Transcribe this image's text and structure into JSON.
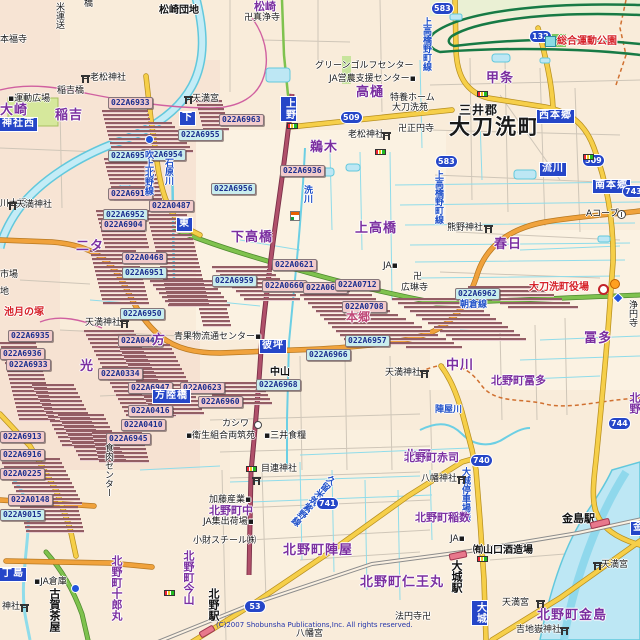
{
  "map": {
    "attribution": "(C)2007 Shobunsha Publications,Inc. All rights reserved.",
    "colors": {
      "background": "#F9ECDA",
      "water_fill": "#BDE7F4",
      "water_line": "#62C8DC",
      "road_yellow": "#F6CF49",
      "road_orange": "#F0A23C",
      "road_green": "#7FC24E",
      "road_red": "#B0506A",
      "expressway_green": "#177A45",
      "boundary_magenta": "#D060A0",
      "boundary_dashed": "#D07030",
      "label_purple": "#7B2FA0",
      "label_red": "#D6232A",
      "blue_box": "#2546C8",
      "code_pink": "#F2CBCB",
      "code_cyan": "#C9EDED",
      "stripe_dark": "#935D64",
      "railway_gray": "#8C8C8C",
      "station_pink": "#E8788C"
    },
    "shields": [
      {
        "n": "583",
        "x": 432,
        "y": 3
      },
      {
        "n": "132",
        "x": 530,
        "y": 31
      },
      {
        "n": "509",
        "x": 341,
        "y": 112
      },
      {
        "n": "583",
        "x": 436,
        "y": 156
      },
      {
        "n": "509",
        "x": 583,
        "y": 155
      },
      {
        "n": "743",
        "x": 623,
        "y": 186
      },
      {
        "n": "744",
        "x": 609,
        "y": 418
      },
      {
        "n": "740",
        "x": 471,
        "y": 455
      },
      {
        "n": "741",
        "x": 317,
        "y": 498
      },
      {
        "n": "53",
        "x": 245,
        "y": 601
      }
    ],
    "blue_boxes": [
      {
        "t": "上野",
        "x": 281,
        "y": 97,
        "v": true
      },
      {
        "t": "下",
        "x": 180,
        "y": 112,
        "v": false
      },
      {
        "t": "神社西",
        "x": 0,
        "y": 118,
        "v": false
      },
      {
        "t": "東",
        "x": 177,
        "y": 218,
        "v": false
      },
      {
        "t": "西本郷",
        "x": 537,
        "y": 110,
        "v": false
      },
      {
        "t": "流川",
        "x": 540,
        "y": 163,
        "v": false
      },
      {
        "t": "南本郷",
        "x": 593,
        "y": 180,
        "v": false
      },
      {
        "t": "彼坪",
        "x": 260,
        "y": 340,
        "v": false
      },
      {
        "t": "方陸橋",
        "x": 153,
        "y": 390,
        "v": false
      },
      {
        "t": "丁島",
        "x": 0,
        "y": 568,
        "v": false
      },
      {
        "t": "大城",
        "x": 472,
        "y": 601,
        "v": true
      },
      {
        "t": "金",
        "x": 631,
        "y": 522,
        "v": false
      }
    ],
    "labels": [
      {
        "t": "米運送",
        "x": 54,
        "y": 2,
        "c": "c-poi",
        "v": true
      },
      {
        "t": "松崎団地",
        "x": 159,
        "y": 6,
        "c": "c-poib"
      },
      {
        "t": "橋",
        "x": 84,
        "y": 0,
        "c": "c-poi"
      },
      {
        "t": "本福寺",
        "x": 0,
        "y": 36,
        "c": "c-poi"
      },
      {
        "t": "卍真浄寺",
        "x": 244,
        "y": 14,
        "c": "c-poi"
      },
      {
        "t": "松崎",
        "x": 254,
        "y": 1,
        "c": "c-loc2"
      },
      {
        "t": "老松神社",
        "x": 90,
        "y": 74,
        "c": "c-poi"
      },
      {
        "t": "稲吉橋",
        "x": 57,
        "y": 87,
        "c": "c-poi"
      },
      {
        "t": "▪運動広場",
        "x": 8,
        "y": 95,
        "c": "c-poi"
      },
      {
        "t": "稲吉",
        "x": 55,
        "y": 109,
        "c": "c-loc"
      },
      {
        "t": "大崎",
        "x": 0,
        "y": 104,
        "c": "c-loc"
      },
      {
        "t": "天満宮",
        "x": 192,
        "y": 95,
        "c": "c-poi"
      },
      {
        "t": "グリーンゴルフセンター",
        "x": 315,
        "y": 62,
        "c": "c-poi"
      },
      {
        "t": "JA営農支援センター▪",
        "x": 329,
        "y": 75,
        "c": "c-poi"
      },
      {
        "t": "高樋",
        "x": 356,
        "y": 86,
        "c": "c-loc"
      },
      {
        "t": "特養ホーム",
        "x": 390,
        "y": 94,
        "c": "c-poi"
      },
      {
        "t": "大刀洗苑",
        "x": 392,
        "y": 104,
        "c": "c-poi"
      },
      {
        "t": "卍正円寺",
        "x": 398,
        "y": 125,
        "c": "c-poi"
      },
      {
        "t": "老松神社",
        "x": 348,
        "y": 131,
        "c": "c-poi"
      },
      {
        "t": "鵜木",
        "x": 310,
        "y": 141,
        "c": "c-loc"
      },
      {
        "t": "甲条",
        "x": 486,
        "y": 72,
        "c": "c-loc"
      },
      {
        "t": "三井郡",
        "x": 459,
        "y": 104,
        "c": "c-sub"
      },
      {
        "t": "大刀洗町",
        "x": 449,
        "y": 117,
        "c": "c-city"
      },
      {
        "t": "総合運動公園",
        "x": 557,
        "y": 37,
        "c": "c-red"
      },
      {
        "t": "上高橋野町線",
        "x": 421,
        "y": 17,
        "c": "c-road",
        "v": true
      },
      {
        "t": "上高橋野町線",
        "x": 433,
        "y": 170,
        "c": "c-road",
        "v": true
      },
      {
        "t": "吹上北野線",
        "x": 143,
        "y": 150,
        "c": "c-road",
        "v": true
      },
      {
        "t": "石原川",
        "x": 163,
        "y": 158,
        "c": "c-riv",
        "v": true
      },
      {
        "t": "川大橋",
        "x": 0,
        "y": 200,
        "c": "c-poi"
      },
      {
        "t": "天満神社",
        "x": 16,
        "y": 201,
        "c": "c-poi"
      },
      {
        "t": "市場",
        "x": 0,
        "y": 271,
        "c": "c-poi"
      },
      {
        "t": "地",
        "x": 0,
        "y": 288,
        "c": "c-poi"
      },
      {
        "t": "二タ",
        "x": 76,
        "y": 240,
        "c": "c-loc"
      },
      {
        "t": "下高橋",
        "x": 231,
        "y": 231,
        "c": "c-loc"
      },
      {
        "t": "上高橋",
        "x": 355,
        "y": 222,
        "c": "c-loc"
      },
      {
        "t": "洗川",
        "x": 302,
        "y": 185,
        "c": "c-riv",
        "v": true
      },
      {
        "t": "熊野神社",
        "x": 447,
        "y": 224,
        "c": "c-poi"
      },
      {
        "t": "春日",
        "x": 494,
        "y": 238,
        "c": "c-loc"
      },
      {
        "t": "Aコープ",
        "x": 586,
        "y": 210,
        "c": "c-poi"
      },
      {
        "t": "JA▪",
        "x": 383,
        "y": 262,
        "c": "c-poi"
      },
      {
        "t": "卍",
        "x": 413,
        "y": 273,
        "c": "c-poi"
      },
      {
        "t": "広琳寺",
        "x": 401,
        "y": 284,
        "c": "c-poi"
      },
      {
        "t": "本郷",
        "x": 346,
        "y": 311,
        "c": "c-hon"
      },
      {
        "t": "大刀洗町役場",
        "x": 529,
        "y": 283,
        "c": "c-red"
      },
      {
        "t": "浄円寺",
        "x": 627,
        "y": 300,
        "c": "c-poi",
        "v": true
      },
      {
        "t": "朝倉線",
        "x": 460,
        "y": 301,
        "c": "c-road"
      },
      {
        "t": "池月の塚",
        "x": 4,
        "y": 308,
        "c": "c-red"
      },
      {
        "t": "天満神社",
        "x": 85,
        "y": 319,
        "c": "c-poi"
      },
      {
        "t": "光",
        "x": 80,
        "y": 360,
        "c": "c-loc"
      },
      {
        "t": "方",
        "x": 152,
        "y": 334,
        "c": "c-loc"
      },
      {
        "t": "青果物流通センター▪",
        "x": 174,
        "y": 333,
        "c": "c-poi"
      },
      {
        "t": "冨多",
        "x": 584,
        "y": 332,
        "c": "c-loc"
      },
      {
        "t": "中川",
        "x": 446,
        "y": 359,
        "c": "c-loc"
      },
      {
        "t": "中山",
        "x": 270,
        "y": 368,
        "c": "c-poib"
      },
      {
        "t": "天満神社",
        "x": 385,
        "y": 369,
        "c": "c-poi"
      },
      {
        "t": "北野町冨多",
        "x": 491,
        "y": 375,
        "c": "c-loc2"
      },
      {
        "t": "陣屋川",
        "x": 435,
        "y": 406,
        "c": "c-riv"
      },
      {
        "t": "北野",
        "x": 629,
        "y": 392,
        "c": "c-loc2",
        "v": true
      },
      {
        "t": "カシワ",
        "x": 222,
        "y": 420,
        "c": "c-poi"
      },
      {
        "t": "▪衛生組合両筑苑",
        "x": 186,
        "y": 432,
        "c": "c-poi"
      },
      {
        "t": "▪三井食糧",
        "x": 264,
        "y": 432,
        "c": "c-poi"
      },
      {
        "t": "食肉センター",
        "x": 103,
        "y": 443,
        "c": "c-poi",
        "v": true
      },
      {
        "t": "北野",
        "x": 404,
        "y": 450,
        "c": "c-loc"
      },
      {
        "t": "北野町赤司",
        "x": 404,
        "y": 452,
        "c": "c-loc2"
      },
      {
        "t": "目連神社",
        "x": 261,
        "y": 465,
        "c": "c-poi"
      },
      {
        "t": "八幡神社",
        "x": 421,
        "y": 475,
        "c": "c-poi"
      },
      {
        "t": "大城停車場線",
        "x": 460,
        "y": 467,
        "c": "c-road",
        "v": true
      },
      {
        "t": "久留米筑紫野線",
        "x": 308,
        "y": 468,
        "c": "c-road",
        "v": true,
        "r": 40
      },
      {
        "t": "加藤産業▪",
        "x": 209,
        "y": 496,
        "c": "c-poi"
      },
      {
        "t": "北野町中",
        "x": 209,
        "y": 505,
        "c": "c-loc2"
      },
      {
        "t": "JA集出荷場▪",
        "x": 203,
        "y": 518,
        "c": "c-poi"
      },
      {
        "t": "北野町稲数",
        "x": 415,
        "y": 512,
        "c": "c-loc2"
      },
      {
        "t": "小財スチール㈱",
        "x": 193,
        "y": 537,
        "c": "c-poi"
      },
      {
        "t": "JA▪",
        "x": 450,
        "y": 535,
        "c": "c-poi"
      },
      {
        "t": "㈲山口酒造場",
        "x": 473,
        "y": 546,
        "c": "c-poib"
      },
      {
        "t": "金島駅",
        "x": 562,
        "y": 513,
        "c": "c-sta"
      },
      {
        "t": "大城駅",
        "x": 451,
        "y": 560,
        "c": "c-sta",
        "v": true
      },
      {
        "t": "北野町陣屋",
        "x": 283,
        "y": 544,
        "c": "c-loc"
      },
      {
        "t": "北野町今山",
        "x": 183,
        "y": 550,
        "c": "c-loc2",
        "v": true
      },
      {
        "t": "北野町十郎丸",
        "x": 111,
        "y": 555,
        "c": "c-loc2",
        "v": true
      },
      {
        "t": "▪JA倉庫",
        "x": 34,
        "y": 578,
        "c": "c-poi"
      },
      {
        "t": "古賀茶屋",
        "x": 49,
        "y": 588,
        "c": "c-sta",
        "v": true
      },
      {
        "t": "天満宮",
        "x": 601,
        "y": 561,
        "c": "c-poi"
      },
      {
        "t": "北野町仁王丸",
        "x": 360,
        "y": 576,
        "c": "c-loc"
      },
      {
        "t": "北野駅",
        "x": 208,
        "y": 588,
        "c": "c-sta",
        "v": true
      },
      {
        "t": "天満宮",
        "x": 502,
        "y": 599,
        "c": "c-poi"
      },
      {
        "t": "神社",
        "x": 2,
        "y": 603,
        "c": "c-poi"
      },
      {
        "t": "北野町金島",
        "x": 537,
        "y": 609,
        "c": "c-loc"
      },
      {
        "t": "法円寺卍",
        "x": 395,
        "y": 613,
        "c": "c-poi"
      },
      {
        "t": "吉地嶽神社",
        "x": 516,
        "y": 626,
        "c": "c-poi"
      },
      {
        "t": "八幡宮",
        "x": 296,
        "y": 630,
        "c": "c-poi"
      }
    ],
    "codes": [
      {
        "t": "022A6933",
        "x": 108,
        "y": 97
      },
      {
        "t": "022A6963",
        "x": 219,
        "y": 114
      },
      {
        "t": "022A6955",
        "x": 178,
        "y": 129,
        "cy": true
      },
      {
        "t": "022A6954",
        "x": 141,
        "y": 149,
        "cy": true
      },
      {
        "t": "022A6958",
        "x": 108,
        "y": 150,
        "cy": true
      },
      {
        "t": "022A6911",
        "x": 108,
        "y": 188
      },
      {
        "t": "022A6952",
        "x": 103,
        "y": 209,
        "cy": true
      },
      {
        "t": "022A6904",
        "x": 101,
        "y": 219
      },
      {
        "t": "022A0487",
        "x": 149,
        "y": 200
      },
      {
        "t": "022A0468",
        "x": 122,
        "y": 252
      },
      {
        "t": "022A6951",
        "x": 122,
        "y": 267,
        "cy": true
      },
      {
        "t": "022A6950",
        "x": 120,
        "y": 308,
        "cy": true
      },
      {
        "t": "022A6936",
        "x": 280,
        "y": 165
      },
      {
        "t": "022A6956",
        "x": 211,
        "y": 183,
        "cy": true
      },
      {
        "t": "022A0621",
        "x": 272,
        "y": 259
      },
      {
        "t": "022A6959",
        "x": 212,
        "y": 275,
        "cy": true
      },
      {
        "t": "022A0660",
        "x": 262,
        "y": 280
      },
      {
        "t": "022A0682",
        "x": 303,
        "y": 282
      },
      {
        "t": "022A0712",
        "x": 335,
        "y": 279
      },
      {
        "t": "022A0708",
        "x": 342,
        "y": 301
      },
      {
        "t": "022A6957",
        "x": 345,
        "y": 335,
        "cy": true
      },
      {
        "t": "022A6966",
        "x": 306,
        "y": 349,
        "cy": true
      },
      {
        "t": "022A6968",
        "x": 256,
        "y": 379,
        "cy": true
      },
      {
        "t": "022A6960",
        "x": 198,
        "y": 396
      },
      {
        "t": "022A6962",
        "x": 455,
        "y": 288,
        "cy": true
      },
      {
        "t": "022A6935",
        "x": 8,
        "y": 330
      },
      {
        "t": "022A6936",
        "x": 0,
        "y": 348
      },
      {
        "t": "022A6933",
        "x": 6,
        "y": 359
      },
      {
        "t": "022A0446",
        "x": 118,
        "y": 335
      },
      {
        "t": "022A0334",
        "x": 98,
        "y": 368
      },
      {
        "t": "022A6947",
        "x": 128,
        "y": 382
      },
      {
        "t": "022A0623",
        "x": 180,
        "y": 382
      },
      {
        "t": "022A0416",
        "x": 128,
        "y": 405
      },
      {
        "t": "022A0410",
        "x": 121,
        "y": 419
      },
      {
        "t": "022A6945",
        "x": 106,
        "y": 433
      },
      {
        "t": "022A6913",
        "x": 0,
        "y": 431
      },
      {
        "t": "022A6916",
        "x": 0,
        "y": 449
      },
      {
        "t": "022A0225",
        "x": 0,
        "y": 468
      },
      {
        "t": "022A0148",
        "x": 8,
        "y": 494
      },
      {
        "t": "022A9015",
        "x": 0,
        "y": 509,
        "cy": true
      }
    ],
    "stacks": [
      {
        "x": 102,
        "y": 110,
        "w": 46,
        "n": 12,
        "dx": 1
      },
      {
        "x": 104,
        "y": 158,
        "w": 48,
        "n": 11,
        "dx": 1
      },
      {
        "x": 130,
        "y": 122,
        "w": 42,
        "n": 8,
        "dx": 3
      },
      {
        "x": 196,
        "y": 100,
        "w": 26,
        "n": 8,
        "dx": 1
      },
      {
        "x": 96,
        "y": 210,
        "w": 44,
        "n": 10,
        "dx": 1
      },
      {
        "x": 90,
        "y": 250,
        "w": 46,
        "n": 14,
        "dx": 1
      },
      {
        "x": 146,
        "y": 210,
        "w": 40,
        "n": 24,
        "dx": 1
      },
      {
        "x": 84,
        "y": 330,
        "w": 50,
        "n": 22,
        "dx": 2
      },
      {
        "x": 118,
        "y": 344,
        "w": 52,
        "n": 18,
        "dx": 2
      },
      {
        "x": 0,
        "y": 342,
        "w": 36,
        "n": 20,
        "dx": 1
      },
      {
        "x": 32,
        "y": 384,
        "w": 42,
        "n": 16,
        "dx": 2
      },
      {
        "x": 58,
        "y": 414,
        "w": 46,
        "n": 12,
        "dx": 2
      },
      {
        "x": 92,
        "y": 432,
        "w": 50,
        "n": 8,
        "dx": 1
      },
      {
        "x": 0,
        "y": 458,
        "w": 60,
        "n": 12,
        "dx": 2
      },
      {
        "x": 18,
        "y": 498,
        "w": 58,
        "n": 9,
        "dx": 1
      },
      {
        "x": 212,
        "y": 266,
        "w": 56,
        "n": 9,
        "dx": 4
      },
      {
        "x": 150,
        "y": 280,
        "w": 62,
        "n": 7,
        "dx": 3
      },
      {
        "x": 286,
        "y": 286,
        "w": 56,
        "n": 16,
        "dx": 8
      },
      {
        "x": 300,
        "y": 294,
        "w": 72,
        "n": 13,
        "dx": 4
      },
      {
        "x": 392,
        "y": 298,
        "w": 74,
        "n": 11,
        "dx": 6
      },
      {
        "x": 468,
        "y": 286,
        "w": 70,
        "n": 6,
        "dx": 8
      },
      {
        "x": 206,
        "y": 382,
        "w": 56,
        "n": 6,
        "dx": 2
      },
      {
        "x": 198,
        "y": 304,
        "w": 28,
        "n": 6,
        "dx": 1
      }
    ],
    "icons": [
      {
        "k": "torii",
        "x": 81,
        "y": 75
      },
      {
        "k": "torii",
        "x": 184,
        "y": 96
      },
      {
        "k": "torii",
        "x": 8,
        "y": 202
      },
      {
        "k": "torii",
        "x": 382,
        "y": 132
      },
      {
        "k": "torii",
        "x": 484,
        "y": 225
      },
      {
        "k": "torii",
        "x": 120,
        "y": 320
      },
      {
        "k": "torii",
        "x": 420,
        "y": 370
      },
      {
        "k": "torii",
        "x": 252,
        "y": 477
      },
      {
        "k": "torii",
        "x": 457,
        "y": 476
      },
      {
        "k": "torii",
        "x": 593,
        "y": 562
      },
      {
        "k": "torii",
        "x": 536,
        "y": 600
      },
      {
        "k": "torii",
        "x": 560,
        "y": 627
      },
      {
        "k": "torii",
        "x": 20,
        "y": 604
      },
      {
        "k": "signal",
        "x": 287,
        "y": 123
      },
      {
        "k": "signal",
        "x": 375,
        "y": 149
      },
      {
        "k": "signal",
        "x": 583,
        "y": 154
      },
      {
        "k": "signal",
        "x": 477,
        "y": 91
      },
      {
        "k": "signal",
        "x": 477,
        "y": 556
      },
      {
        "k": "signal",
        "x": 246,
        "y": 466
      },
      {
        "k": "signal",
        "x": 164,
        "y": 590
      },
      {
        "k": "office",
        "x": 598,
        "y": 284
      },
      {
        "k": "fire",
        "x": 610,
        "y": 279
      },
      {
        "k": "conv",
        "x": 290,
        "y": 211
      },
      {
        "k": "school",
        "x": 254,
        "y": 421
      },
      {
        "k": "bus",
        "x": 145,
        "y": 135
      },
      {
        "k": "bus",
        "x": 71,
        "y": 584
      },
      {
        "k": "diamond",
        "x": 615,
        "y": 295
      },
      {
        "k": "leisure",
        "x": 545,
        "y": 36
      },
      {
        "k": "coop",
        "x": 617,
        "y": 210
      }
    ],
    "stations": [
      {
        "x": 449,
        "y": 552,
        "w": 16,
        "h": 5,
        "r": -12
      },
      {
        "x": 590,
        "y": 520,
        "w": 18,
        "h": 5,
        "r": -14
      },
      {
        "x": 199,
        "y": 628,
        "w": 14,
        "h": 5,
        "r": -30
      }
    ]
  }
}
